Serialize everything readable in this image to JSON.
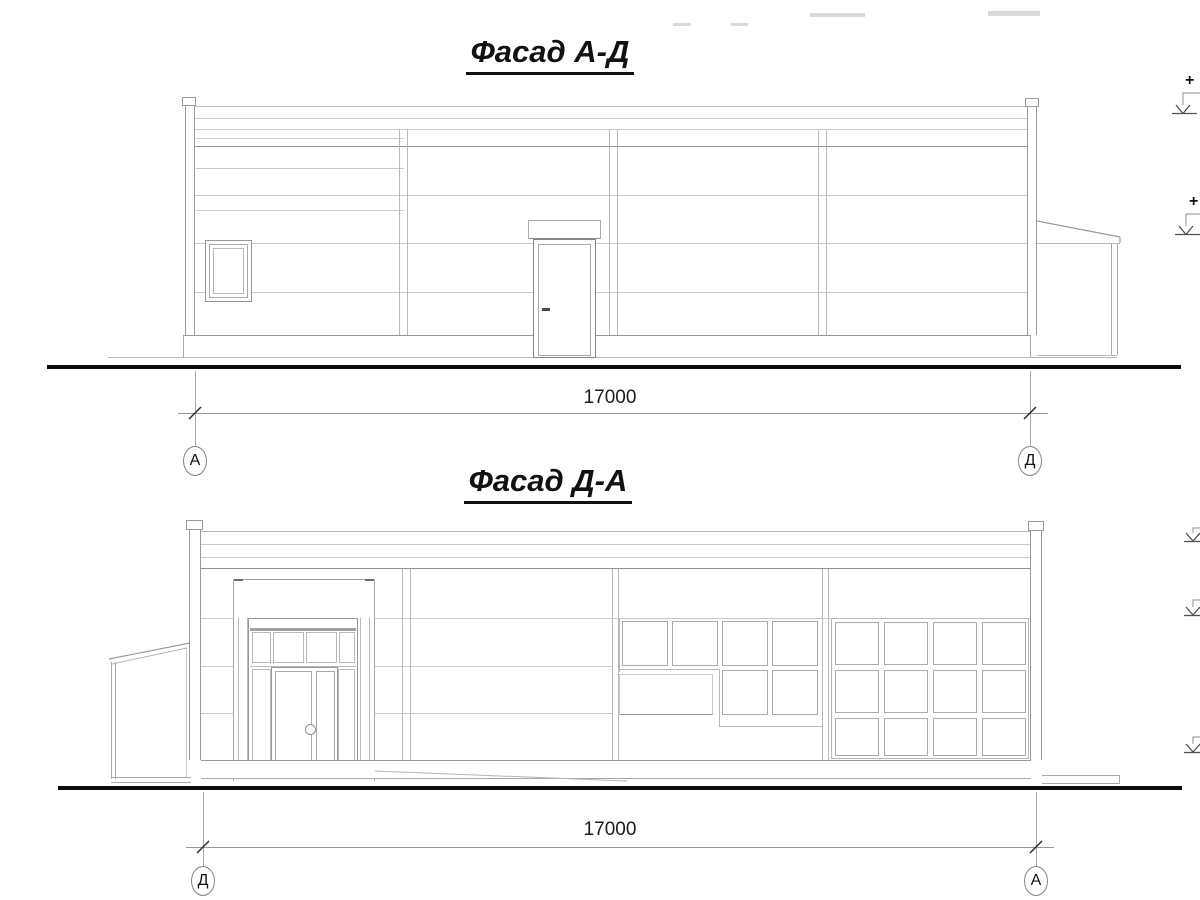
{
  "views": [
    {
      "id": "facade-a-d",
      "title": "Фасад А-Д",
      "dimension_label": "17000",
      "axis_left": "А",
      "axis_right": "Д",
      "elevation_plus": "+"
    },
    {
      "id": "facade-d-a",
      "title": "Фасад Д-А",
      "dimension_label": "17000",
      "axis_left": "Д",
      "axis_right": "А"
    }
  ],
  "colors": {
    "line_light": "#c9c9cd",
    "line_mid": "#a9a9ad",
    "line_dark": "#96969a",
    "ink": "#151515",
    "ground": "#0b0b0b"
  }
}
